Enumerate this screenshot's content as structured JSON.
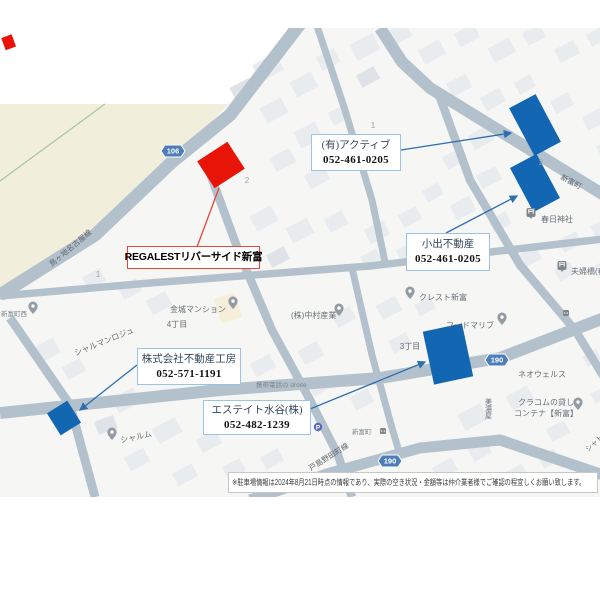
{
  "subject": {
    "label": "REGALESTリバーサイド新富"
  },
  "callouts": [
    {
      "name": "(有)アクティブ",
      "phone": "052-461-0205"
    },
    {
      "name": "小出不動産",
      "phone": "052-461-0205"
    },
    {
      "name": "株式会社不動産工房",
      "phone": "052-571-1191"
    },
    {
      "name": "エステイト水谷(株)",
      "phone": "052-482-1239"
    }
  ],
  "disclaimer": {
    "text": "※駐車場情報は2024年8月21日時点の情報であり、実際の空き状況・金額等は仲介業者様でご確認の程宜しくお願い致します。"
  },
  "route_badges": [
    {
      "label": "106"
    },
    {
      "label": "190"
    },
    {
      "label": "190"
    }
  ],
  "road_labels": [
    {
      "text": "鳥ヶ地名古屋線"
    },
    {
      "text": "新富町"
    },
    {
      "text": "戸島野田町線"
    }
  ],
  "map_labels": [
    {
      "text": "1"
    },
    {
      "text": "2"
    },
    {
      "text": "2"
    },
    {
      "text": "1"
    },
    {
      "text": "3"
    },
    {
      "text": "4丁目"
    },
    {
      "text": "3丁目"
    },
    {
      "text": "金城マンション"
    },
    {
      "text": "シャルマンロジュ"
    },
    {
      "text": "シャルム"
    },
    {
      "text": "(株)中村産業"
    },
    {
      "text": "クレスト新富"
    },
    {
      "text": "フードマリブ"
    },
    {
      "text": "春日神社"
    },
    {
      "text": "夫婦橋(春"
    },
    {
      "text": "ネオウェルス"
    },
    {
      "text": "クラコムの貸し"
    },
    {
      "text": "コンテナ【新富】"
    },
    {
      "text": "新富町西"
    },
    {
      "text": "携帯電話の droite"
    },
    {
      "text": "美濃屋"
    },
    {
      "text": "シャトル"
    },
    {
      "text": "新富町"
    }
  ],
  "icons": {
    "poi_pin": "map-pin",
    "shrine_pin": "torii-gate",
    "parking_pin": "P",
    "signal": "traffic-signal"
  },
  "colors": {
    "highlight_blue": "#1266b2",
    "highlight_red": "#e91408",
    "road": "#b3c1cc",
    "map_bg": "#f6f7f4",
    "building": "#e9ecef",
    "field_beige": "#f2eedc",
    "callout_border": "#9cc2e5",
    "callout_border_red": "#e8463b",
    "leader_blue": "#2f6eb0",
    "badge_blue": "#4d7eb8"
  }
}
